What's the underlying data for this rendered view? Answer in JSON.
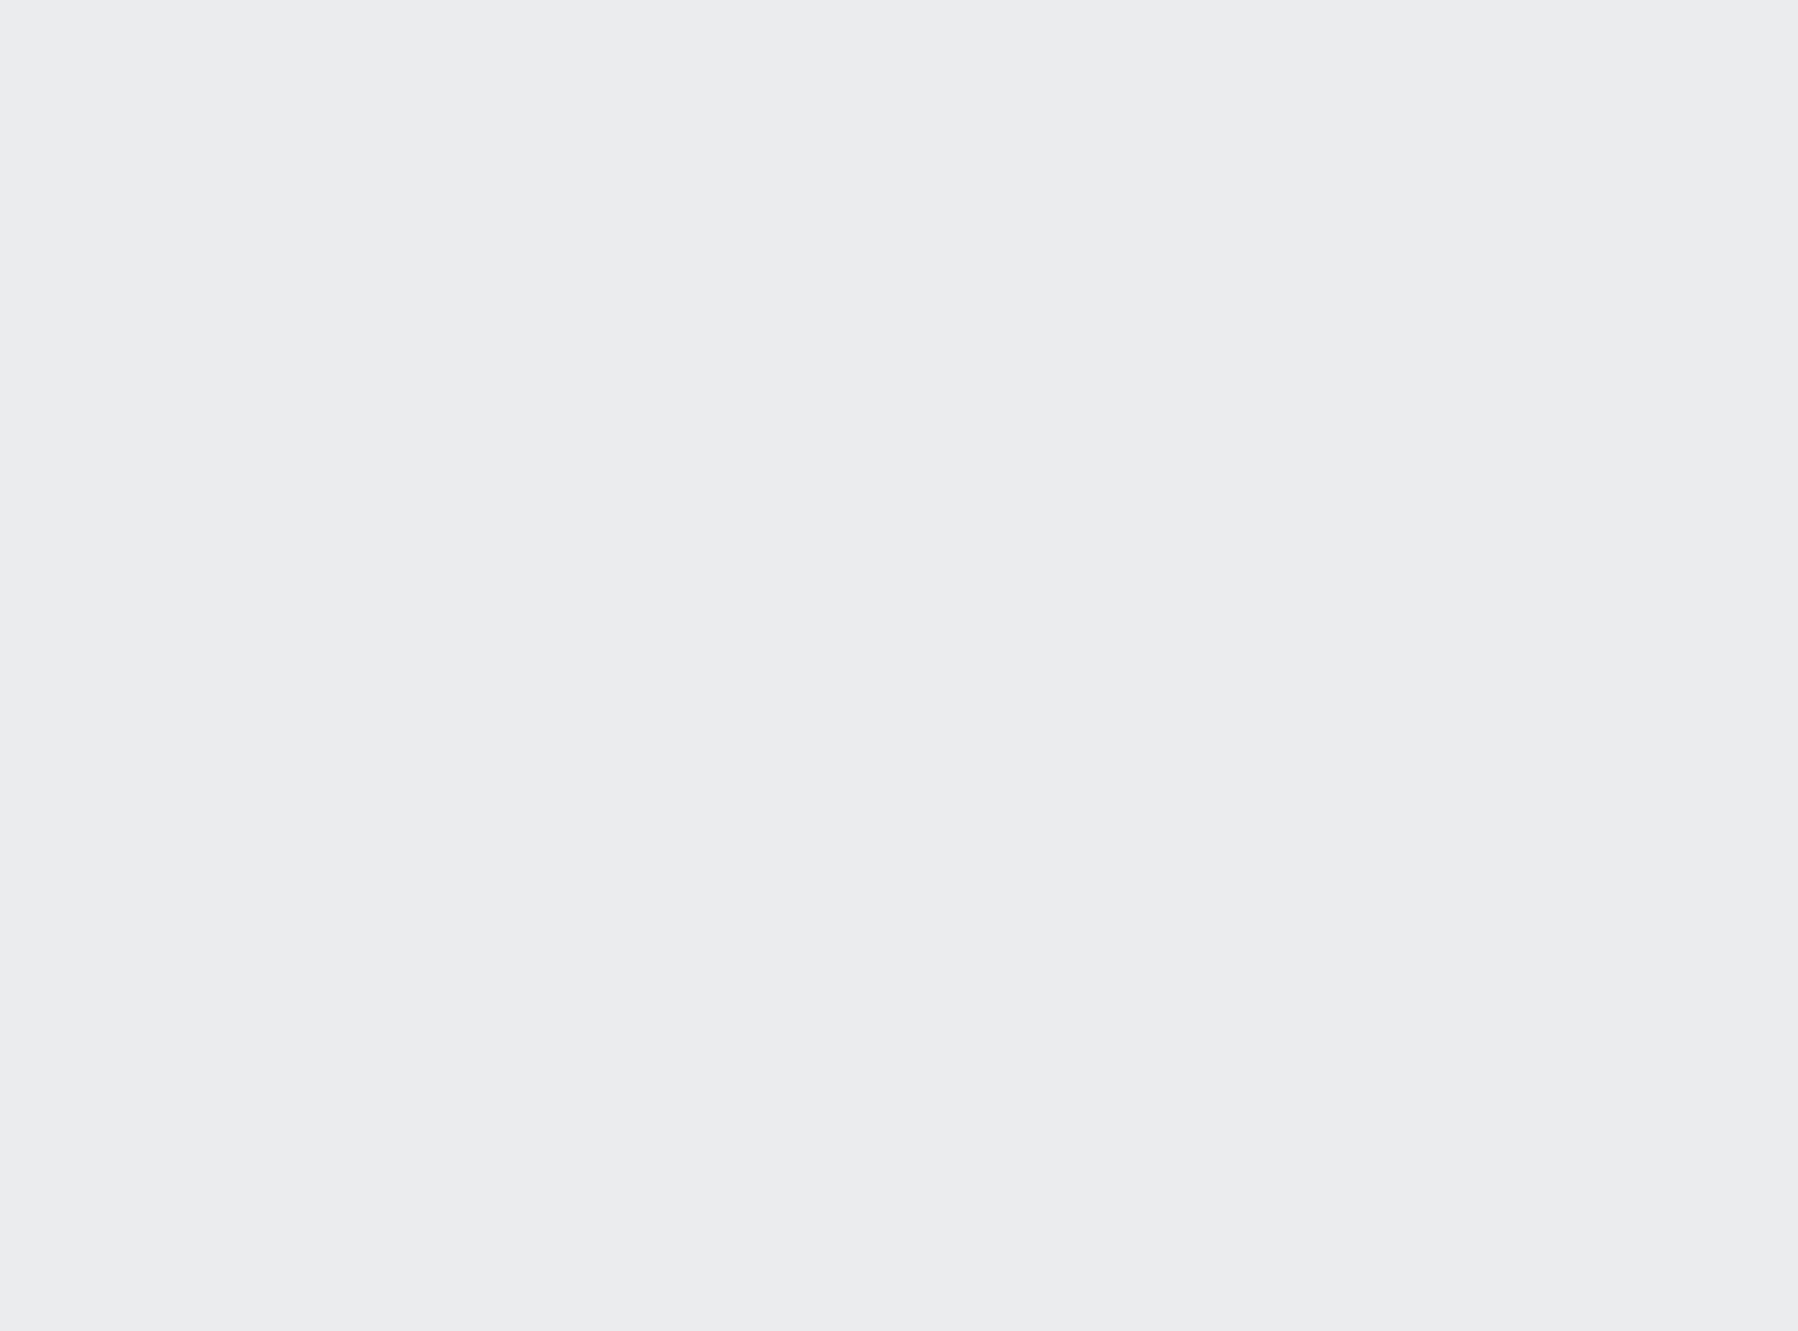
{
  "meta": {
    "image_type": "3d-isometric-apartment-floorplan-render",
    "visible_text": "none"
  },
  "rooms": [
    {
      "name": "kids-bedroom-yellow",
      "features": [
        "blue-headboard-platform-bed",
        "yellow-pillows",
        "bunting-flags",
        "brown-curtains",
        "window"
      ]
    },
    {
      "name": "study-nook",
      "features": [
        "wood-desk",
        "yellow-chair",
        "rhino-poster",
        "dark-shutter",
        "bookshelf"
      ]
    },
    {
      "name": "laundry",
      "features": [
        "washing-machine",
        "black-marble-counter",
        "white-wall-cabinets",
        "sink"
      ]
    },
    {
      "name": "kitchen-tea-room",
      "features": [
        "wood-paneled-walls",
        "black-framed-windows",
        "tea-table",
        "bar-counter",
        "teal-panel",
        "black-fridge"
      ]
    },
    {
      "name": "dining-room",
      "features": [
        "wood-table-white-top",
        "teal-runner",
        "place-settings",
        "gray-chairs",
        "sideboard-teal-cubbies"
      ]
    },
    {
      "name": "hallway",
      "features": [
        "gray-marble-tile",
        "white-doors-black-dots",
        "low-cut-walls"
      ]
    },
    {
      "name": "kids-bedroom-pink",
      "features": [
        "hello-kitty-bed",
        "pink-white-wardrobe",
        "pink-desk-chair",
        "white-desk-counter"
      ]
    },
    {
      "name": "living-room",
      "features": [
        "gray-sectional-sofa",
        "chaise-lounge",
        "marble-coffee-table",
        "mosaic-rug",
        "tv-wall-wood-shelves",
        "movie-poster-tv"
      ]
    },
    {
      "name": "master-bedroom",
      "features": [
        "gray-bed",
        "striped-blanket",
        "wood-white-wardrobe",
        "vanity-corner",
        "white-pouf",
        "gray-window-bench",
        "dark-desk"
      ]
    },
    {
      "name": "balcony",
      "features": [
        "black-metal-glass-railing",
        "dark-marble-floor",
        "green-armchairs",
        "round-black-table"
      ]
    }
  ],
  "palette": {
    "bg": "#ebecee",
    "shadow": "#bcbdc0",
    "slabTop": "#e4e6e7",
    "slabEdge": "#c6cacc",
    "wallTop": "#a7b1bd",
    "cream": "#ece7dc",
    "white": "#f4f4f5",
    "cutTop": "#ccd3d0",
    "marble": "#cac5c1",
    "marbleLight": "#d8d3cf",
    "hallMarble": "#b5b2b0",
    "woodFloor": "#dbc9ad",
    "woodFloorLight": "#e7d9c3",
    "kitchenFloor": "#d9d2c4",
    "wood": "#b18656",
    "woodLight": "#c79f6f",
    "woodDark": "#6e5434",
    "teal": "#8ed2d6",
    "tealPale": "#c2e4e6",
    "blue": "#7f9fc5",
    "yellow": "#f2b237",
    "sofa": "#7b7c80",
    "sofaDark": "#5e5f63",
    "cushion": "#a3a4a7",
    "pink": "#f5d3de",
    "pinkDeep": "#eaa9bf",
    "pinkWall": "#e8b7c8",
    "green": "#86976f",
    "black": "#2d3136",
    "nearBlack": "#1d2024",
    "darkGray": "#4a4d52",
    "benchGray": "#a7aaa8",
    "rug": "#9c9c9e",
    "rugLight": "#c6c4c1",
    "glass": "#eef2f4",
    "glassBlue": "#dfe7ea",
    "curtain": "#4b3b27",
    "shutter": "#3a3126",
    "marbleWhite": "#f6f5f2",
    "blanket": "#8e8f93",
    "sheet": "#efeeec",
    "poster": "#23262b",
    "orange": "#e0812f",
    "red": "#c4392e",
    "doorWhite": "#f0f1f2",
    "counterBlack": "#332e2c"
  }
}
